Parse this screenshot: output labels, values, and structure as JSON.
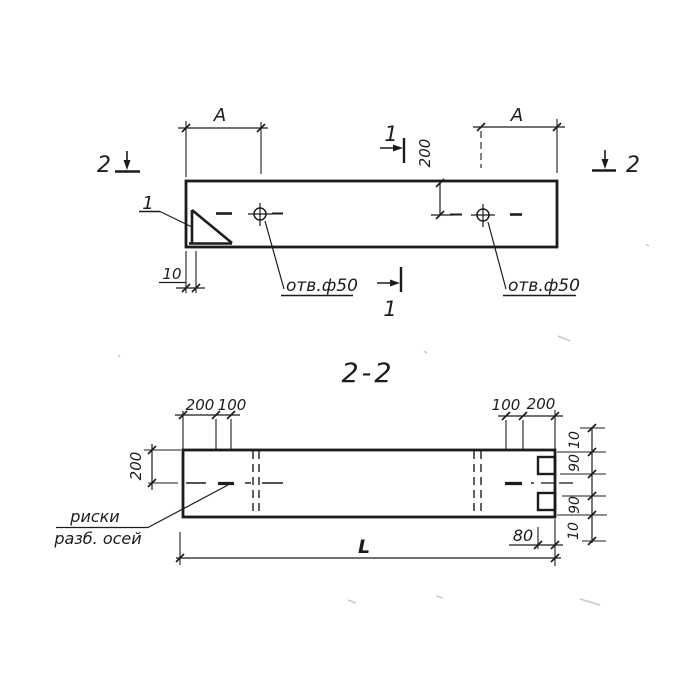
{
  "colors": {
    "ink": "#1c1c1c",
    "paper": "#ffffff"
  },
  "plan": {
    "dim_a_left": "A",
    "dim_a_right": "A",
    "dim_200": "200",
    "dim_10": "10",
    "hole_left": "отв.ф50",
    "hole_right": "отв.ф50",
    "callout_1": "1",
    "sec1_top": "1",
    "sec1_bottom": "1",
    "sec2_left": "2",
    "sec2_right": "2"
  },
  "section": {
    "title": "2-2",
    "top_left_200": "200",
    "top_left_100": "100",
    "top_right_100": "100",
    "top_right_200": "200",
    "left_200": "200",
    "right_10_top": "10",
    "right_90_top": "90",
    "right_90_bottom": "90",
    "right_10_bottom": "10",
    "dim_80": "80",
    "dim_L": "L",
    "axis_line1": "риски",
    "axis_line2": "разб. осей"
  }
}
